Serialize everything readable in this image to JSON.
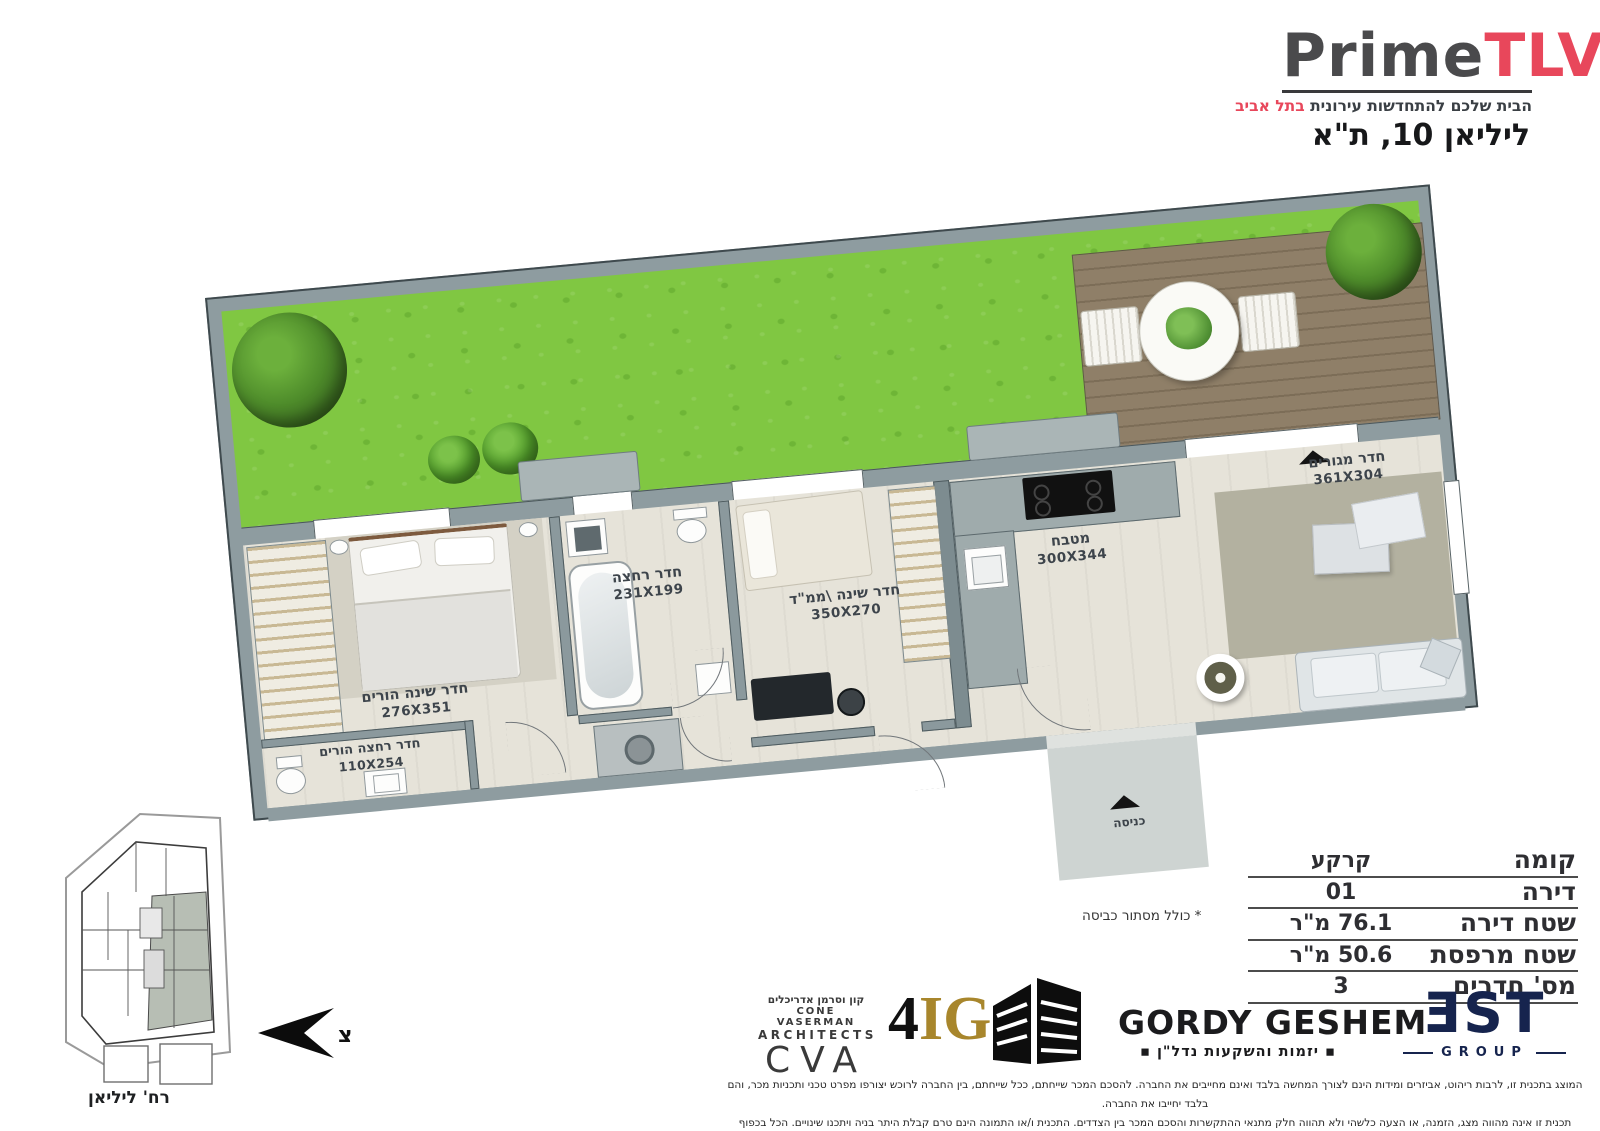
{
  "header": {
    "brand_prime": "Prime",
    "brand_tlv": "TLV",
    "tagline_main": "הבית שלכם להתחדשות עירונית",
    "tagline_accent": "בתל אביב",
    "address": "ליליאן 10, ת\"א"
  },
  "floorplan": {
    "rooms": [
      {
        "name": "חדר שינה הורים",
        "dims": "276X351"
      },
      {
        "name": "חדר רחצה הורים",
        "dims": "110X254"
      },
      {
        "name": "חדר רחצה",
        "dims": "231X199"
      },
      {
        "name": "חדר שינה \\ממ\"ד",
        "dims": "350X270"
      },
      {
        "name": "מטבח",
        "dims": "300X344"
      },
      {
        "name": "חדר מגורים",
        "dims": "361X304"
      }
    ],
    "entrance_label": "כניסה"
  },
  "site": {
    "side_street": "רח' אנטוקולסקי",
    "bottom_street": "רח' ליליאן",
    "north_letter": "צ"
  },
  "spec_table": {
    "rows": [
      {
        "label": "קומה",
        "value": "קרקע"
      },
      {
        "label": "דירה",
        "value": "01"
      },
      {
        "label": "שטח דירה",
        "value": "76.1 מ\"ר"
      },
      {
        "label": "שטח מרפסת",
        "value": "50.6 מ\"ר"
      },
      {
        "label": "מס' חדרים",
        "value": "3"
      }
    ],
    "note": "* כולל מסתור כביסה"
  },
  "logos": {
    "cva": {
      "hebrew": "קון וסרמן אדריכלים",
      "line_en1": "CONE VASERMAN",
      "line_en2": "ARCHITECTS",
      "abbr": "CVA"
    },
    "ig": {
      "four": "4",
      "ig": "IG"
    },
    "gordy": {
      "name": "GORDY GESHEM",
      "sub": "▪ יזמות והשקעות נדל\"ן ▪"
    },
    "bst": {
      "name": "ƎST",
      "group": "GROUP"
    }
  },
  "disclaimer": {
    "line1": "המוצג בתכנית זו, לרבות ריהוט, אביזרים ומידות הינם לצורך המחשה בלבד ואינם מחייבים את החברה. להסכם המכר שייחתם, ככל שייחתם, בין החברה לרוכש יצורפו מפרט טכני ותכניות מכר, והם בלבד יחייבו את החברה.",
    "line2": "תכנית זו אינה מהווה מצג, הזמנה, או הצעה כלשהי ולא תהווה חלק מתנאי ההתקשרות והסכם המכר בין הצדדים. התכנית ו/או התמונה הינם טרם קבלת היתר בניה ויתכנו שינויים. הכל בכפוף להוראות הסכם המכר על נספחיו, לרבות נספח רכישה מוקדמת."
  },
  "colors": {
    "accent_red": "#e8475b",
    "navy": "#16244e",
    "gold": "#a8862c",
    "grass_green": "#80c742",
    "deck_brown": "#8f7f68",
    "wall_gray": "#8e9ca0"
  }
}
